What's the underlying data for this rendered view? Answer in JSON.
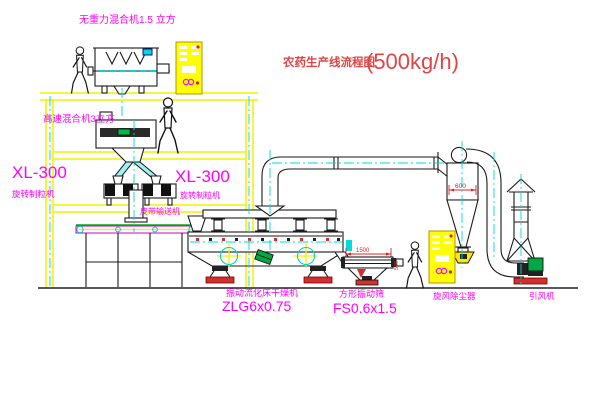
{
  "title": {
    "text": "农药生产线流程图",
    "capacity": "(500kg/h)"
  },
  "equipment_labels": {
    "gravity_mixer": "无重力混合机1.5 立方",
    "high_speed_mixer": "高速混合机3立方",
    "granulator_left_model": "XL-300",
    "granulator_left_name": "旋转制粒机",
    "granulator_mid_model": "XL-300",
    "granulator_mid_name": "旋转制粒机",
    "belt_conveyor": "皮带输送机",
    "dryer_name": "振动流化床干燥机",
    "dryer_model": "ZLG6x0.75",
    "screen_name": "方形振动筛",
    "screen_model": "FS0.6x1.5",
    "cyclone_name": "旋风除尘器",
    "fan_name": "引风机"
  },
  "dimensions": {
    "cyclone_diameter": "600",
    "screen_length": "1500",
    "screen_width": "540"
  },
  "colors": {
    "background": "#ffffff",
    "structure_yellow": "#f2f200",
    "centerline_cyan": "#00d8d8",
    "label_magenta": "#ff00ff",
    "title_red": "#e04545",
    "dimension_red": "#e02020",
    "machine_black": "#1a1a1a",
    "motor_green": "#00a843",
    "base_red": "#d03030",
    "cabinet_yellow": "#ffff00"
  }
}
